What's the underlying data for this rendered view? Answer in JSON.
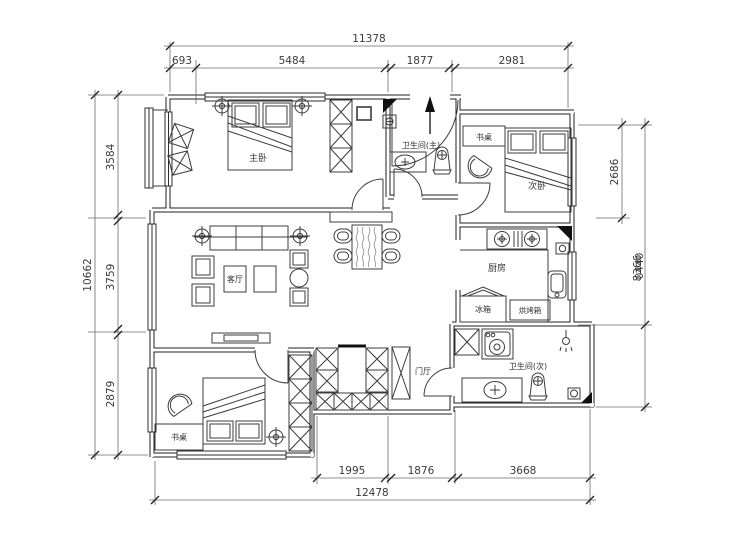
{
  "drawing": {
    "dimensions": {
      "top": {
        "total": "11378",
        "segments": [
          "693",
          "5484",
          "1877",
          "2981"
        ]
      },
      "bottom": {
        "total": "12478",
        "segments": [
          "1995",
          "1876",
          "3668"
        ]
      },
      "left": {
        "total": "10662",
        "segments": [
          "3584",
          "3759",
          "2879"
        ]
      },
      "right": {
        "upper": "2686",
        "lower": "8366",
        "lower_overlap": "0440"
      }
    },
    "rooms": {
      "master_bedroom": "主卧",
      "second_bedroom": "次卧",
      "living_room": "客厅",
      "kitchen": "厨房",
      "entry_hall": "门厅",
      "master_bath": "卫生间(主)",
      "second_bath": "卫生间(次)"
    },
    "furniture_labels": {
      "desk_bedroom_bottom": "书桌",
      "desk_bedroom_top": "书桌",
      "fridge": "冰箱",
      "oven": "烘烤箱"
    },
    "colors": {
      "wall": "#1f1f1f",
      "line": "#3c3c3c",
      "dim_line": "#6b6b6b",
      "text": "#333333",
      "background": "#ffffff"
    }
  }
}
